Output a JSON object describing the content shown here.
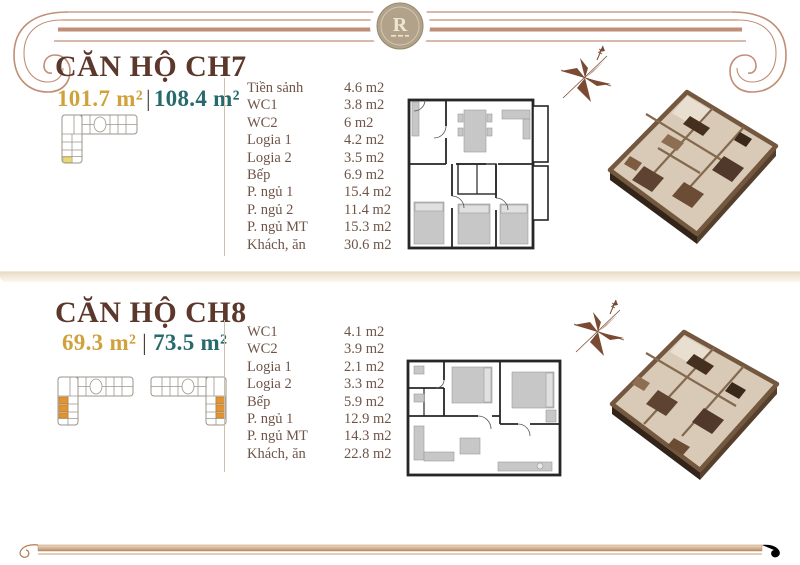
{
  "header": {
    "logo_monogram": "R"
  },
  "colors": {
    "accent_copper": "#c18d74",
    "title_brown": "#5b382b",
    "area_gold": "#d0a23b",
    "area_teal": "#266a6d",
    "room_text": "#6f5448",
    "keyplan_highlight_yellow": "#e9d878",
    "keyplan_highlight_orange": "#e29433",
    "medallion_tan": "#b2a289"
  },
  "units": [
    {
      "title": "CĂN HỘ CH7",
      "area_primary": "101.7 m²",
      "area_separator": "|",
      "area_secondary": "108.4 m²",
      "rooms": [
        {
          "label": "Tiền sảnh",
          "area": "4.6 m2"
        },
        {
          "label": "WC1",
          "area": "3.8 m2"
        },
        {
          "label": "WC2",
          "area": "6 m2"
        },
        {
          "label": "Logia 1",
          "area": "4.2 m2"
        },
        {
          "label": "Logia 2",
          "area": "3.5 m2"
        },
        {
          "label": "Bếp",
          "area": "6.9 m2"
        },
        {
          "label": "P. ngủ 1",
          "area": "15.4 m2"
        },
        {
          "label": "P. ngủ 2",
          "area": "11.4 m2"
        },
        {
          "label": "P. ngủ MT",
          "area": "15.3 m2"
        },
        {
          "label": "Khách, ăn",
          "area": "30.6 m2"
        }
      ]
    },
    {
      "title": "CĂN HỘ CH8",
      "area_primary": "69.3 m²",
      "area_separator": "|",
      "area_secondary": "73.5 m²",
      "rooms": [
        {
          "label": "WC1",
          "area": "4.1 m2"
        },
        {
          "label": "WC2",
          "area": "3.9 m2"
        },
        {
          "label": "Logia 1",
          "area": "2.1 m2"
        },
        {
          "label": "Logia 2",
          "area": "3.3 m2"
        },
        {
          "label": "Bếp",
          "area": "5.9 m2"
        },
        {
          "label": "P. ngủ 1",
          "area": "12.9 m2"
        },
        {
          "label": "P. ngủ MT",
          "area": "14.3 m2"
        },
        {
          "label": "Khách, ăn",
          "area": "22.8 m2"
        }
      ]
    }
  ]
}
